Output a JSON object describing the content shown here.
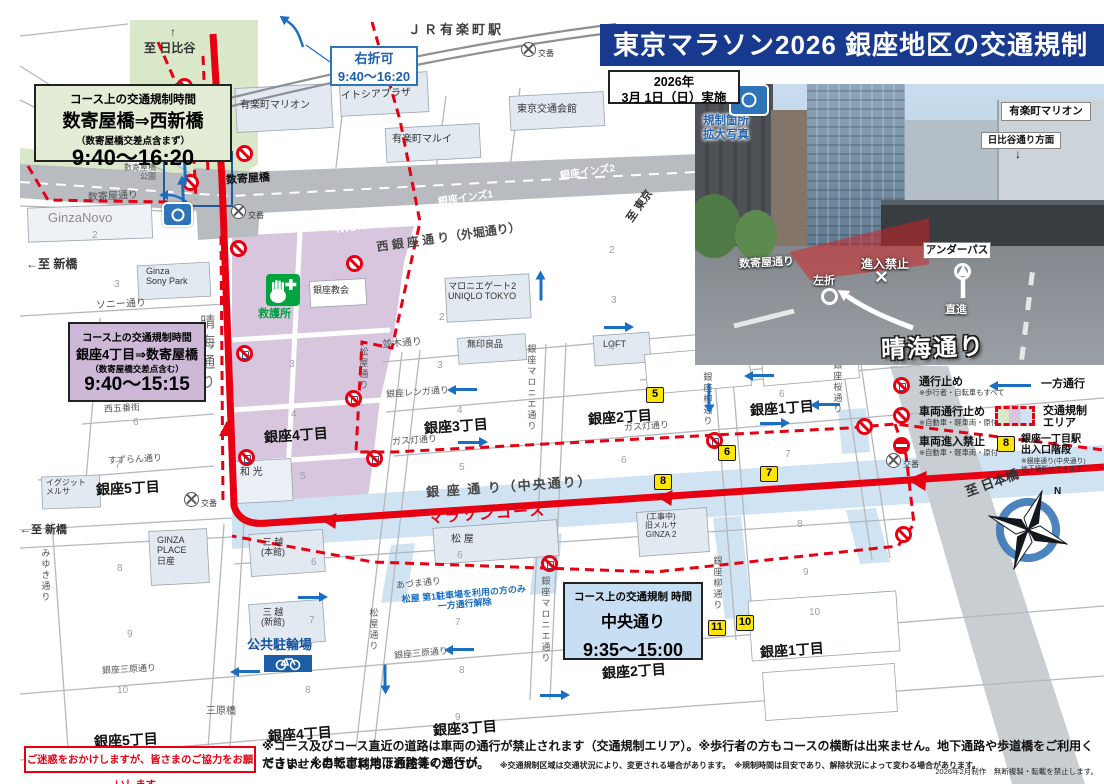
{
  "title": "東京マラソン2026 銀座地区の交通規制",
  "date_box": {
    "year": "2026年",
    "date": "3月 1日（日）実施"
  },
  "photo_tag": {
    "label": "規制箇所\n拡大写真"
  },
  "photo": {
    "building_sign": "有楽町マリオン",
    "hibiya": "日比谷通り方面",
    "hibiya_arrow": "↓",
    "sukiya_street": "数寄屋通り",
    "left_turn": "左折",
    "no_entry": "進入禁止",
    "cross": "×",
    "underpass": "アンダーパス",
    "straight": "直進",
    "harumi": "晴海通り"
  },
  "boxes": {
    "green": {
      "heading": "コース上の交通規制時間",
      "route": "数寄屋橋⇒西新橋",
      "note": "（数寄屋橋交差点含まず）",
      "time": "9:40～16:20"
    },
    "purple": {
      "heading": "コース上の交通規制時間",
      "route": "銀座4丁目⇒数寄屋橋",
      "note": "（数寄屋橋交差点含む）",
      "time": "9:40～15:15"
    },
    "blue": {
      "heading": "コース上の交通規制 時間",
      "route": "中央通り",
      "time": "9:35～15:00"
    },
    "right_turn": {
      "line1": "右折可",
      "line2": "9:40～16:20"
    }
  },
  "legend": {
    "closed": {
      "label": "通行止め",
      "note": "※歩行者・自転車もすべて"
    },
    "vehicle_closed": {
      "label": "車両通行止め",
      "note": "※自動車・軽車両・原付"
    },
    "no_entry": {
      "label": "車両進入禁止",
      "note": "※自動車・軽車両・原付"
    },
    "one_way": {
      "label": "一方通行"
    },
    "area": {
      "label": "交通規制\nエリア"
    },
    "station": {
      "marker": "8",
      "label": "銀座一丁目駅\n出入口階段",
      "note": "※銀座通り(中央通り)\n地下横断はできます"
    }
  },
  "footer": {
    "apology": "ご迷惑をおかけしますが、皆さまのご協力をお願いします。",
    "line1": "※コース及びコース直近の道路は車両の通行が禁止されます（交通規制エリア）。※歩行者の方もコースの横断は出来ません。地下通路や歩道橋をご利用ください。※自転車は地下通路等の通行が",
    "line2": "できませんのでご利用はお控えください。",
    "small": "※交通規制区域は交通状況により、変更される場合があります。　※規制時間は目安であり、解除状況によって変わる場合があります。",
    "credit": "2026年2月制作　無断複製・転載を禁止します。"
  },
  "colors": {
    "course_red": "#e60012",
    "one_way_blue": "#1b6ec2",
    "title_bg": "#183a8e",
    "marker_yellow": "#ffe600",
    "area_green": "#d9e8c8",
    "area_purple": "#d8c6de",
    "area_blue": "#cfe3f2"
  },
  "map": {
    "photo_ref": "写真参照",
    "koban_label": "交番",
    "labels": [
      {
        "k": "direction",
        "t": "↑",
        "x": 170,
        "y": 26,
        "s": 12,
        "c": "#333",
        "w": 1
      },
      {
        "k": "direction",
        "t": "至 日比谷",
        "x": 144,
        "y": 42,
        "s": 12,
        "c": "#333",
        "w": 1
      },
      {
        "k": "direction",
        "t": "←至 新橋",
        "x": 26,
        "y": 258,
        "s": 12,
        "c": "#333",
        "w": 1
      },
      {
        "k": "direction",
        "t": "←至 新橋",
        "x": 20,
        "y": 524,
        "s": 11,
        "c": "#333",
        "w": 1
      },
      {
        "k": "direction",
        "t": "至 東京",
        "x": 622,
        "y": 200,
        "s": 11,
        "c": "#333",
        "w": 1,
        "r": -55
      },
      {
        "k": "direction",
        "t": "至 日本橋→",
        "x": 964,
        "y": 474,
        "s": 13,
        "c": "#333",
        "w": 1,
        "r": -20
      },
      {
        "k": "direction",
        "t": "三原橋",
        "x": 206,
        "y": 706,
        "s": 10,
        "c": "#555"
      },
      {
        "k": "street",
        "t": "ＪＲ有楽町駅",
        "x": 408,
        "y": 23,
        "s": 13,
        "c": "#3f3f3f",
        "w": 1,
        "ls": 3
      },
      {
        "k": "street",
        "t": "数寄屋橋",
        "x": 226,
        "y": 173,
        "s": 11,
        "c": "#111",
        "w": 1,
        "r": -4
      },
      {
        "k": "street",
        "t": "数寄屋橋\n公園",
        "x": 124,
        "y": 163,
        "s": 8,
        "c": "#555",
        "al": "right"
      },
      {
        "k": "street",
        "t": "数寄屋通り",
        "x": 88,
        "y": 191,
        "s": 10,
        "c": "#555",
        "r": -3
      },
      {
        "k": "street",
        "t": "NISHIGINZA",
        "x": 336,
        "y": 219,
        "s": 11,
        "c": "#fff",
        "w": 1,
        "r": -8,
        "ls": 1
      },
      {
        "k": "street",
        "t": "銀座インズ1",
        "x": 438,
        "y": 193,
        "s": 10,
        "c": "#fff",
        "w": 1,
        "r": -8
      },
      {
        "k": "street",
        "t": "銀座インズ2",
        "x": 560,
        "y": 167,
        "s": 10,
        "c": "#fff",
        "w": 1,
        "r": -8
      },
      {
        "k": "street",
        "t": "西 銀 座 通 り（外堀通り）",
        "x": 376,
        "y": 231,
        "s": 12,
        "c": "#474747",
        "w": 1,
        "r": -8
      },
      {
        "k": "street",
        "t": "ソニー通り",
        "x": 96,
        "y": 299,
        "s": 10,
        "c": "#555",
        "r": -3
      },
      {
        "k": "street",
        "t": "西五番街",
        "x": 104,
        "y": 403,
        "s": 9,
        "c": "#555",
        "r": -3
      },
      {
        "k": "street",
        "t": "すずらん通り",
        "x": 108,
        "y": 454,
        "s": 9,
        "c": "#555",
        "r": -3
      },
      {
        "k": "street",
        "t": "みゆき通り",
        "x": 40,
        "y": 548,
        "s": 9,
        "c": "#555",
        "v": 1
      },
      {
        "k": "street",
        "t": "晴海通り",
        "x": 198,
        "y": 314,
        "s": 15,
        "c": "#6d6d6d",
        "v": 1,
        "ls": 5
      },
      {
        "k": "street",
        "t": "並木通り",
        "x": 382,
        "y": 338,
        "s": 10,
        "c": "#555",
        "r": -4
      },
      {
        "k": "street",
        "t": "松屋通り",
        "x": 358,
        "y": 347,
        "s": 9,
        "c": "#555",
        "v": 1
      },
      {
        "k": "street",
        "t": "松屋通り",
        "x": 368,
        "y": 608,
        "s": 9,
        "c": "#555",
        "v": 1
      },
      {
        "k": "street",
        "t": "銀座レンガ通り",
        "x": 386,
        "y": 387,
        "s": 9,
        "c": "#555",
        "r": -4
      },
      {
        "k": "street",
        "t": "ガス灯通り",
        "x": 392,
        "y": 435,
        "s": 9,
        "c": "#555",
        "r": -4
      },
      {
        "k": "street",
        "t": "ガス灯通り",
        "x": 624,
        "y": 421,
        "s": 9,
        "c": "#555",
        "r": -4
      },
      {
        "k": "street",
        "t": "銀座マロニエ通り",
        "x": 526,
        "y": 344,
        "s": 9,
        "c": "#555",
        "v": 1
      },
      {
        "k": "street",
        "t": "銀座マロニエ通り",
        "x": 540,
        "y": 576,
        "s": 9,
        "c": "#555",
        "v": 1
      },
      {
        "k": "street",
        "t": "銀座柳通り",
        "x": 702,
        "y": 372,
        "s": 9,
        "c": "#555",
        "v": 1
      },
      {
        "k": "street",
        "t": "銀座柳通り",
        "x": 712,
        "y": 556,
        "s": 9,
        "c": "#555",
        "v": 1
      },
      {
        "k": "street",
        "t": "銀座桜通り",
        "x": 832,
        "y": 360,
        "s": 9,
        "c": "#555",
        "v": 1
      },
      {
        "k": "street",
        "t": "あづま通り",
        "x": 396,
        "y": 578,
        "s": 9,
        "c": "#555",
        "r": -6
      },
      {
        "k": "street",
        "t": "銀座三原通り",
        "x": 394,
        "y": 648,
        "s": 9,
        "c": "#555",
        "r": -5
      },
      {
        "k": "street",
        "t": "銀座三原通り",
        "x": 102,
        "y": 664,
        "s": 9,
        "c": "#555",
        "r": -3
      },
      {
        "k": "street",
        "t": "銀 座 通 り（中央通り）",
        "x": 426,
        "y": 480,
        "s": 13,
        "c": "#474747",
        "w": 1,
        "r": -4,
        "ls": 2
      },
      {
        "k": "course",
        "t": "マラソンコース",
        "x": 428,
        "y": 506,
        "s": 15,
        "c": "#e60012",
        "w": 1,
        "r": -4,
        "ls": 2
      },
      {
        "k": "note",
        "t": "↑地下",
        "x": 186,
        "y": 88,
        "s": 9,
        "c": "#333",
        "v": 1
      },
      {
        "k": "note",
        "t": "救護所",
        "x": 258,
        "y": 308,
        "s": 11,
        "c": "#00a042",
        "w": 1
      },
      {
        "k": "note",
        "t": "公共駐輪場",
        "x": 247,
        "y": 638,
        "s": 13,
        "c": "#1553a0",
        "w": 1
      },
      {
        "k": "note",
        "t": "松屋 第1駐車場を利用の方のみ\n一方通行解除",
        "x": 402,
        "y": 589,
        "s": 9,
        "c": "#1b6ec2",
        "w": 1,
        "r": -5,
        "al": "center"
      },
      {
        "k": "note",
        "t": "N",
        "x": 1054,
        "y": 486,
        "s": 10,
        "c": "#111",
        "w": 1
      },
      {
        "k": "building",
        "t": "有楽町マリオン",
        "x": 240,
        "y": 100,
        "s": 10,
        "c": "#333"
      },
      {
        "k": "building",
        "t": "イトシアプラザ",
        "x": 341,
        "y": 89,
        "s": 10,
        "c": "#333",
        "r": -3
      },
      {
        "k": "building",
        "t": "有楽町マルイ",
        "x": 392,
        "y": 134,
        "s": 10,
        "c": "#333"
      },
      {
        "k": "building",
        "t": "東京交通会館",
        "x": 517,
        "y": 104,
        "s": 10,
        "c": "#333"
      },
      {
        "k": "building",
        "t": "マロニエゲート2\nUNIQLO TOKYO",
        "x": 448,
        "y": 281,
        "s": 9,
        "c": "#333",
        "al": "center"
      },
      {
        "k": "building",
        "t": "銀座教会",
        "x": 313,
        "y": 285,
        "s": 9,
        "c": "#333"
      },
      {
        "k": "building",
        "t": "Ginza\nSony Park",
        "x": 146,
        "y": 266,
        "s": 9,
        "c": "#333"
      },
      {
        "k": "building",
        "t": "GinzaNovo",
        "x": 48,
        "y": 211,
        "s": 13,
        "c": "#8d8d8d"
      },
      {
        "k": "building",
        "t": "イグジット\nメルサ",
        "x": 46,
        "y": 478,
        "s": 8,
        "c": "#333"
      },
      {
        "k": "building",
        "t": "和 光",
        "x": 240,
        "y": 467,
        "s": 10,
        "c": "#333"
      },
      {
        "k": "building",
        "t": "松 屋",
        "x": 451,
        "y": 534,
        "s": 10,
        "c": "#333"
      },
      {
        "k": "building",
        "t": "三 越\n(本館)",
        "x": 261,
        "y": 537,
        "s": 9,
        "c": "#333",
        "al": "center"
      },
      {
        "k": "building",
        "t": "三 越\n(新館)",
        "x": 261,
        "y": 607,
        "s": 9,
        "c": "#333",
        "al": "center"
      },
      {
        "k": "building",
        "t": "GINZA\nPLACE\n日産",
        "x": 157,
        "y": 535,
        "s": 9,
        "c": "#333"
      },
      {
        "k": "building",
        "t": "LOFT",
        "x": 603,
        "y": 339,
        "s": 9,
        "c": "#333"
      },
      {
        "k": "building",
        "t": "無印良品",
        "x": 467,
        "y": 339,
        "s": 9,
        "c": "#333"
      },
      {
        "k": "building",
        "t": "(工事中)\n旧メルサ\nGINZA 2",
        "x": 645,
        "y": 512,
        "s": 8,
        "c": "#333",
        "al": "center"
      },
      {
        "k": "district",
        "t": "銀座5丁目",
        "x": 96,
        "y": 480,
        "s": 14,
        "c": "#111",
        "w": 1,
        "r": -3
      },
      {
        "k": "district",
        "t": "銀座4丁目",
        "x": 264,
        "y": 427,
        "s": 14,
        "c": "#111",
        "w": 1,
        "r": -4
      },
      {
        "k": "district",
        "t": "銀座3丁目",
        "x": 424,
        "y": 418,
        "s": 14,
        "c": "#111",
        "w": 1,
        "r": -4
      },
      {
        "k": "district",
        "t": "銀座2丁目",
        "x": 588,
        "y": 409,
        "s": 14,
        "c": "#111",
        "w": 1,
        "r": -4
      },
      {
        "k": "district",
        "t": "銀座1丁目",
        "x": 750,
        "y": 400,
        "s": 14,
        "c": "#111",
        "w": 1,
        "r": -4
      },
      {
        "k": "district",
        "t": "銀座5丁目",
        "x": 94,
        "y": 732,
        "s": 14,
        "c": "#111",
        "w": 1,
        "r": -3
      },
      {
        "k": "district",
        "t": "銀座4丁目",
        "x": 268,
        "y": 726,
        "s": 14,
        "c": "#111",
        "w": 1,
        "r": -4
      },
      {
        "k": "district",
        "t": "銀座3丁目",
        "x": 433,
        "y": 720,
        "s": 14,
        "c": "#111",
        "w": 1,
        "r": -4
      },
      {
        "k": "district",
        "t": "銀座2丁目",
        "x": 602,
        "y": 663,
        "s": 14,
        "c": "#111",
        "w": 1,
        "r": -4
      },
      {
        "k": "district",
        "t": "銀座1丁目",
        "x": 760,
        "y": 642,
        "s": 14,
        "c": "#111",
        "w": 1,
        "r": -4
      },
      {
        "k": "block-number",
        "t": "1",
        "x": 130,
        "y": 121,
        "s": 10,
        "c": "#9aa0a8"
      },
      {
        "k": "block-number",
        "t": "2",
        "x": 92,
        "y": 230,
        "s": 10,
        "c": "#9aa0a8"
      },
      {
        "k": "block-number",
        "t": "3",
        "x": 114,
        "y": 279,
        "s": 10,
        "c": "#9aa0a8"
      },
      {
        "k": "block-number",
        "t": "6",
        "x": 133,
        "y": 417,
        "s": 10,
        "c": "#9aa0a8"
      },
      {
        "k": "block-number",
        "t": "7",
        "x": 115,
        "y": 460,
        "s": 10,
        "c": "#9aa0a8"
      },
      {
        "k": "block-number",
        "t": "8",
        "x": 117,
        "y": 563,
        "s": 10,
        "c": "#9aa0a8"
      },
      {
        "k": "block-number",
        "t": "9",
        "x": 127,
        "y": 629,
        "s": 10,
        "c": "#9aa0a8"
      },
      {
        "k": "block-number",
        "t": "10",
        "x": 117,
        "y": 685,
        "s": 10,
        "c": "#9aa0a8"
      },
      {
        "k": "block-number",
        "t": "2",
        "x": 609,
        "y": 245,
        "s": 10,
        "c": "#9aa0a8"
      },
      {
        "k": "block-number",
        "t": "3",
        "x": 611,
        "y": 295,
        "s": 10,
        "c": "#9aa0a8"
      },
      {
        "k": "block-number",
        "t": "2",
        "x": 439,
        "y": 312,
        "s": 10,
        "c": "#9aa0a8"
      },
      {
        "k": "block-number",
        "t": "3",
        "x": 437,
        "y": 360,
        "s": 10,
        "c": "#9aa0a8"
      },
      {
        "k": "block-number",
        "t": "4",
        "x": 457,
        "y": 405,
        "s": 10,
        "c": "#9aa0a8"
      },
      {
        "k": "block-number",
        "t": "5",
        "x": 459,
        "y": 462,
        "s": 10,
        "c": "#9aa0a8"
      },
      {
        "k": "block-number",
        "t": "3",
        "x": 289,
        "y": 359,
        "s": 10,
        "c": "#9aa0a8"
      },
      {
        "k": "block-number",
        "t": "4",
        "x": 291,
        "y": 409,
        "s": 10,
        "c": "#9aa0a8"
      },
      {
        "k": "block-number",
        "t": "5",
        "x": 300,
        "y": 471,
        "s": 10,
        "c": "#9aa0a8"
      },
      {
        "k": "block-number",
        "t": "4",
        "x": 609,
        "y": 342,
        "s": 10,
        "c": "#9aa0a8"
      },
      {
        "k": "block-number",
        "t": "6",
        "x": 621,
        "y": 455,
        "s": 10,
        "c": "#9aa0a8"
      },
      {
        "k": "block-number",
        "t": "6",
        "x": 779,
        "y": 389,
        "s": 10,
        "c": "#9aa0a8"
      },
      {
        "k": "block-number",
        "t": "7",
        "x": 785,
        "y": 449,
        "s": 10,
        "c": "#9aa0a8"
      },
      {
        "k": "block-number",
        "t": "6",
        "x": 311,
        "y": 557,
        "s": 10,
        "c": "#9aa0a8"
      },
      {
        "k": "block-number",
        "t": "7",
        "x": 309,
        "y": 615,
        "s": 10,
        "c": "#9aa0a8"
      },
      {
        "k": "block-number",
        "t": "8",
        "x": 305,
        "y": 685,
        "s": 10,
        "c": "#9aa0a8"
      },
      {
        "k": "block-number",
        "t": "6",
        "x": 457,
        "y": 550,
        "s": 10,
        "c": "#9aa0a8"
      },
      {
        "k": "block-number",
        "t": "7",
        "x": 455,
        "y": 617,
        "s": 10,
        "c": "#9aa0a8"
      },
      {
        "k": "block-number",
        "t": "8",
        "x": 459,
        "y": 665,
        "s": 10,
        "c": "#9aa0a8"
      },
      {
        "k": "block-number",
        "t": "9",
        "x": 455,
        "y": 712,
        "s": 10,
        "c": "#9aa0a8"
      },
      {
        "k": "block-number",
        "t": "8",
        "x": 797,
        "y": 519,
        "s": 10,
        "c": "#9aa0a8"
      },
      {
        "k": "block-number",
        "t": "9",
        "x": 803,
        "y": 567,
        "s": 10,
        "c": "#9aa0a8"
      },
      {
        "k": "block-number",
        "t": "10",
        "x": 809,
        "y": 607,
        "s": 10,
        "c": "#9aa0a8"
      }
    ],
    "markers": [
      {
        "n": "5",
        "x": 646,
        "y": 387
      },
      {
        "n": "6",
        "x": 718,
        "y": 445
      },
      {
        "n": "7",
        "x": 760,
        "y": 466
      },
      {
        "n": "8",
        "x": 654,
        "y": 474
      },
      {
        "n": "10",
        "x": 736,
        "y": 615
      },
      {
        "n": "11",
        "x": 708,
        "y": 620
      }
    ],
    "signs": [
      {
        "x": 176,
        "y": 78,
        "t": "B"
      },
      {
        "x": 236,
        "y": 145,
        "t": "B"
      },
      {
        "x": 182,
        "y": 174,
        "t": "B"
      },
      {
        "x": 230,
        "y": 240,
        "t": "B"
      },
      {
        "x": 346,
        "y": 255,
        "t": "B"
      },
      {
        "x": 236,
        "y": 345,
        "t": "A"
      },
      {
        "x": 238,
        "y": 449,
        "t": "A"
      },
      {
        "x": 345,
        "y": 390,
        "t": "A"
      },
      {
        "x": 366,
        "y": 450,
        "t": "A"
      },
      {
        "x": 706,
        "y": 432,
        "t": "A"
      },
      {
        "x": 541,
        "y": 555,
        "t": "A"
      },
      {
        "x": 856,
        "y": 418,
        "t": "B"
      },
      {
        "x": 895,
        "y": 526,
        "t": "B"
      }
    ],
    "arrows": [
      {
        "x": 752,
        "y": 374,
        "r": 180
      },
      {
        "x": 818,
        "y": 403,
        "r": 180
      },
      {
        "x": 698,
        "y": 393,
        "r": 90
      },
      {
        "x": 760,
        "y": 422,
        "r": 0
      },
      {
        "x": 455,
        "y": 388,
        "r": 180
      },
      {
        "x": 458,
        "y": 441,
        "r": 0
      },
      {
        "x": 530,
        "y": 288,
        "r": -90
      },
      {
        "x": 604,
        "y": 326,
        "r": 0
      },
      {
        "x": 298,
        "y": 596,
        "r": 0
      },
      {
        "x": 452,
        "y": 648,
        "r": 180
      },
      {
        "x": 238,
        "y": 670,
        "r": 180
      },
      {
        "x": 374,
        "y": 674,
        "r": 90
      },
      {
        "x": 540,
        "y": 694,
        "r": 0
      },
      {
        "x": 174,
        "y": 171,
        "r": -92
      },
      {
        "x": 172,
        "y": 193,
        "r": -92
      }
    ],
    "koban": [
      {
        "x": 521,
        "y": 42
      },
      {
        "x": 231,
        "y": 204
      },
      {
        "x": 184,
        "y": 492
      },
      {
        "x": 886,
        "y": 453
      }
    ]
  }
}
